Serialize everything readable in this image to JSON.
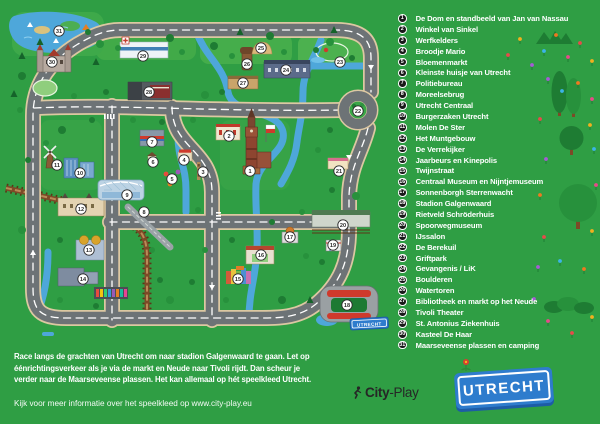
{
  "legend": {
    "items": [
      {
        "num": "1",
        "label": "De Dom en standbeeld van Jan van Nassau"
      },
      {
        "num": "2",
        "label": "Winkel van Sinkel"
      },
      {
        "num": "3",
        "label": "Werfkelders"
      },
      {
        "num": "4",
        "label": "Broodje Mario"
      },
      {
        "num": "5",
        "label": "Bloemenmarkt"
      },
      {
        "num": "6",
        "label": "Kleinste huisje van Utrecht"
      },
      {
        "num": "7",
        "label": "Politiebureau"
      },
      {
        "num": "8",
        "label": "Moreelsebrug"
      },
      {
        "num": "9",
        "label": "Utrecht Centraal"
      },
      {
        "num": "10",
        "label": "Burgerzaken Utrecht"
      },
      {
        "num": "11",
        "label": "Molen De Ster"
      },
      {
        "num": "12",
        "label": "Het Muntgebouw"
      },
      {
        "num": "13",
        "label": "De Verrekijker"
      },
      {
        "num": "14",
        "label": "Jaarbeurs en Kinepolis"
      },
      {
        "num": "15",
        "label": "Twijnstraat"
      },
      {
        "num": "16",
        "label": "Centraal Museum en Nijntjemuseum"
      },
      {
        "num": "17",
        "label": "Sonnenborgh Sterrenwacht"
      },
      {
        "num": "18",
        "label": "Stadion Galgenwaard"
      },
      {
        "num": "19",
        "label": "Rietveld Schröderhuis"
      },
      {
        "num": "20",
        "label": "Spoorwegmuseum"
      },
      {
        "num": "21",
        "label": "IJssalon"
      },
      {
        "num": "22",
        "label": "De Berekuil"
      },
      {
        "num": "23",
        "label": "Griftpark"
      },
      {
        "num": "24",
        "label": "Gevangenis / LiK"
      },
      {
        "num": "25",
        "label": "Boulderen"
      },
      {
        "num": "26",
        "label": "Watertoren"
      },
      {
        "num": "27",
        "label": "Bibliotheek en markt op het Neude"
      },
      {
        "num": "28",
        "label": "Tivoli Theater"
      },
      {
        "num": "29",
        "label": "St. Antonius Ziekenhuis"
      },
      {
        "num": "30",
        "label": "Kasteel De Haar"
      },
      {
        "num": "31",
        "label": "Maarseveense plassen en camping"
      }
    ]
  },
  "intro": {
    "lines": [
      "Race langs de grachten van Utrecht om naar stadion Galgenwaard te gaan. Let op",
      "éénrichtingsverkeer als je via de markt en Neude naar Tivoli rijdt. Dan scheur je",
      "verder naar de Maarseveense plassen. Het kan allemaal op hét speelkleed Utrecht."
    ]
  },
  "footer": {
    "info": "Kijk voor meer informatie over het speelkleed op www.city-play.eu"
  },
  "logo": {
    "brand_bold": "City",
    "brand_rest": "-Play"
  },
  "sign": {
    "label": "UTRECHT"
  },
  "map": {
    "sign_label": "UTRECHT"
  },
  "colors": {
    "background": "#2f9e44",
    "road": "#6d7376",
    "road_edge": "#dcc8a2",
    "water": "#4ea7da",
    "rail": "#7c4a27",
    "legend_circle": "#191919",
    "marker_fill": "#ffffff",
    "sign_blue": "#2e7ccd",
    "sign_edge": "#1d5ca6",
    "stadium_red": "#cf3a2c",
    "text": "#ffffff"
  }
}
